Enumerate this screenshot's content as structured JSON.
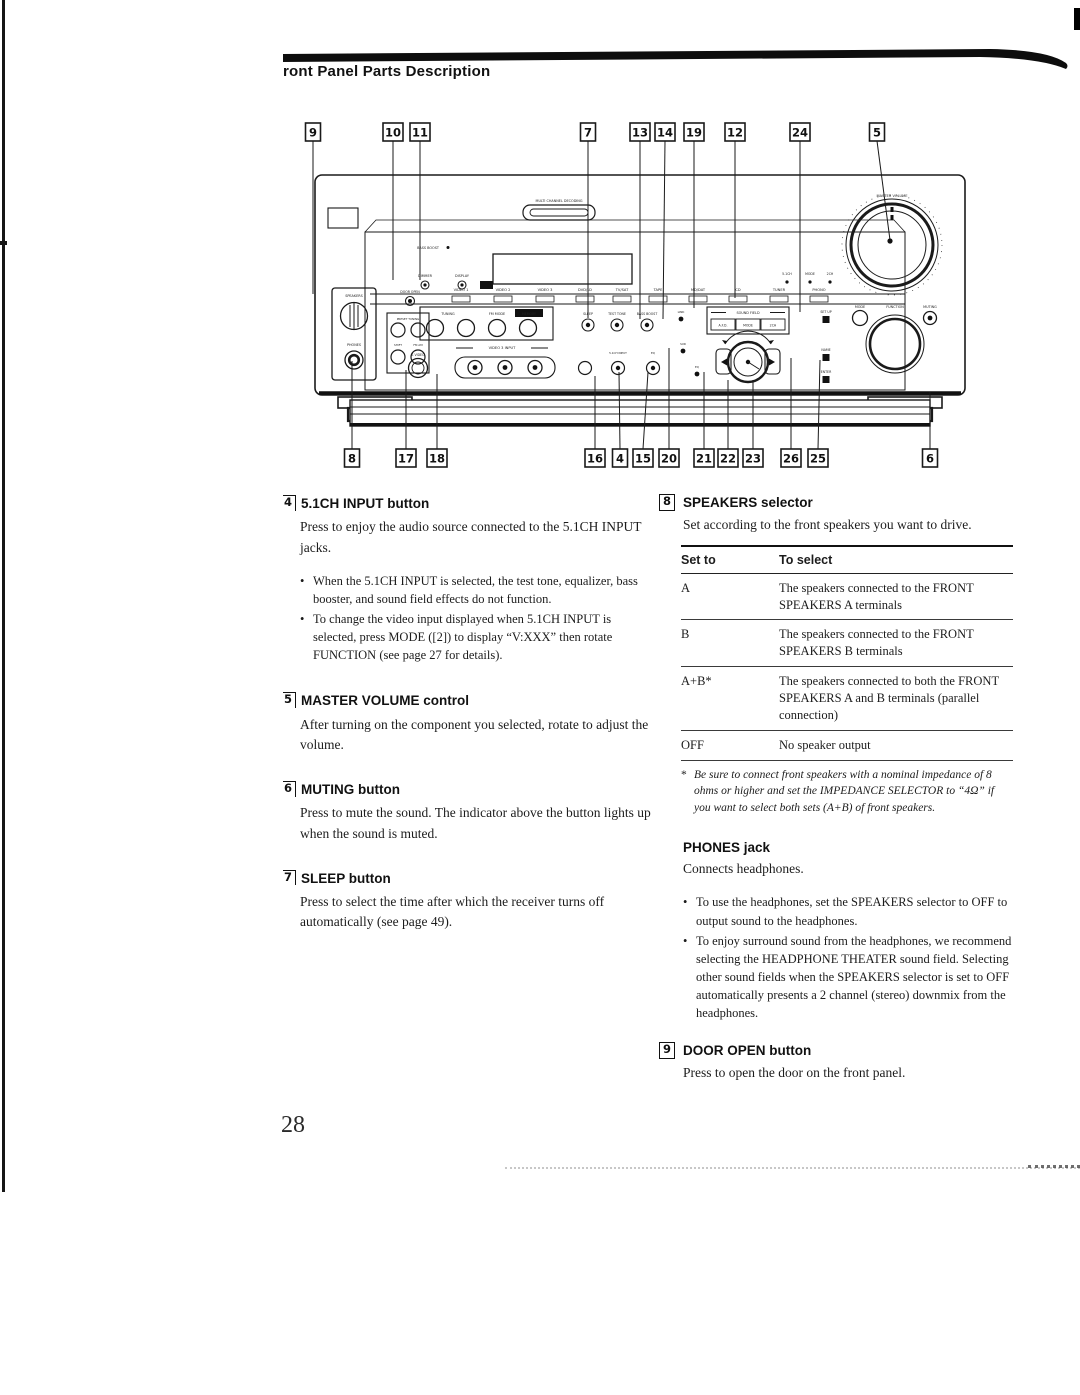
{
  "page": {
    "title": "ront Panel Parts Description",
    "number": "28"
  },
  "diagram": {
    "callouts_top": [
      "9",
      "10",
      "11",
      "7",
      "13",
      "14",
      "19",
      "12",
      "24",
      "5"
    ],
    "callouts_bottom": [
      "8",
      "17",
      "18",
      "16",
      "4",
      "15",
      "20",
      "21",
      "22",
      "23",
      "26",
      "25",
      "6"
    ],
    "labels": {
      "multi_channel": "MULTI CHANNEL DECODING",
      "bass_boost": "BASS BOOST",
      "dimmer": "DIMMER",
      "display": "DISPLAY",
      "ind_51": "5.1CH",
      "ind_mode": "MODE",
      "ind_2ch": "2CH",
      "inputs": [
        "VIDEO 1",
        "VIDEO 2",
        "VIDEO 3",
        "DVD/LD",
        "TV/SAT",
        "TAPE",
        "MD/DAT",
        "CD",
        "TUNER",
        "PHONO"
      ],
      "tuning": "TUNING",
      "fm_mode": "FM MODE",
      "memory": "MEMORY",
      "sleep": "SLEEP",
      "test_tone": "TEST TONE",
      "bass_boost_btn": "BASS BOOST",
      "link": "LINK",
      "sound_field": "SOUND FIELD",
      "afd": "A.F.D.",
      "sf_mode": "MODE",
      "sf_2ch": "2CH",
      "set_up": "SET UP",
      "name": "NAME",
      "enter": "ENTER",
      "video3": "VIDEO 3 INPUT",
      "s_video": "S VIDEO",
      "in_51": "5.1CH INPUT",
      "eq": "EQ",
      "sur": "SUR",
      "eq2": "EQ",
      "speakers": "SPEAKERS",
      "phones": "PHONES",
      "door_open": "DOOR OPEN",
      "preset": "PRESET TUNING",
      "shift": "SHIFT",
      "fm_am": "FM AM",
      "master_volume": "MASTER VOLUME",
      "mode": "MODE",
      "function": "FUNCTION",
      "muting": "MUTING"
    }
  },
  "left": {
    "s4": {
      "num": "4",
      "title": "5.1CH INPUT button",
      "body": "Press to enjoy the audio source connected to the 5.1CH INPUT jacks.",
      "bullets": [
        "When the 5.1CH INPUT is selected, the test tone, equalizer, bass booster, and sound field effects do not function.",
        "To change the video input displayed when 5.1CH INPUT is selected, press MODE ([2]) to display “V:XXX” then rotate FUNCTION (see page 27 for details)."
      ]
    },
    "s5": {
      "num": "5",
      "title": "MASTER VOLUME control",
      "body": "After turning on the component you selected, rotate to adjust the volume."
    },
    "s6": {
      "num": "6",
      "title": "MUTING button",
      "body": "Press to mute the sound.  The indicator above the button lights up when the sound is muted."
    },
    "s7": {
      "num": "7",
      "title": "SLEEP button",
      "body": "Press to select the time after which the receiver turns off automatically (see page 49)."
    }
  },
  "right": {
    "s8": {
      "num": "8",
      "title": "SPEAKERS selector",
      "body": "Set according to the front speakers you want to drive.",
      "table": {
        "h1": "Set to",
        "h2": "To select",
        "rows": [
          {
            "set": "A",
            "desc": "The speakers connected to the FRONT SPEAKERS A terminals"
          },
          {
            "set": "B",
            "desc": "The speakers connected to the FRONT SPEAKERS B terminals"
          },
          {
            "set": "A+B*",
            "desc": "The speakers connected to both the FRONT SPEAKERS A and B terminals (parallel connection)"
          },
          {
            "set": "OFF",
            "desc": "No speaker output"
          }
        ]
      },
      "footnote_mark": "*",
      "footnote": "Be sure to connect front speakers with a nominal impedance of 8 ohms or higher and set the IMPEDANCE SELECTOR to “4Ω” if you want to select both sets (A+B) of front speakers."
    },
    "phones": {
      "title": "PHONES jack",
      "body": "Connects headphones.",
      "bullets": [
        "To use the headphones, set the SPEAKERS selector to OFF to output sound to the headphones.",
        "To enjoy surround sound from the headphones, we recommend selecting the HEADPHONE THEATER sound field. Selecting other sound fields when the SPEAKERS selector is set to OFF automatically presents a 2 channel (stereo) downmix from the headphones."
      ]
    },
    "s9": {
      "num": "9",
      "title": "DOOR OPEN button",
      "body": "Press to open the door on the front panel."
    }
  }
}
